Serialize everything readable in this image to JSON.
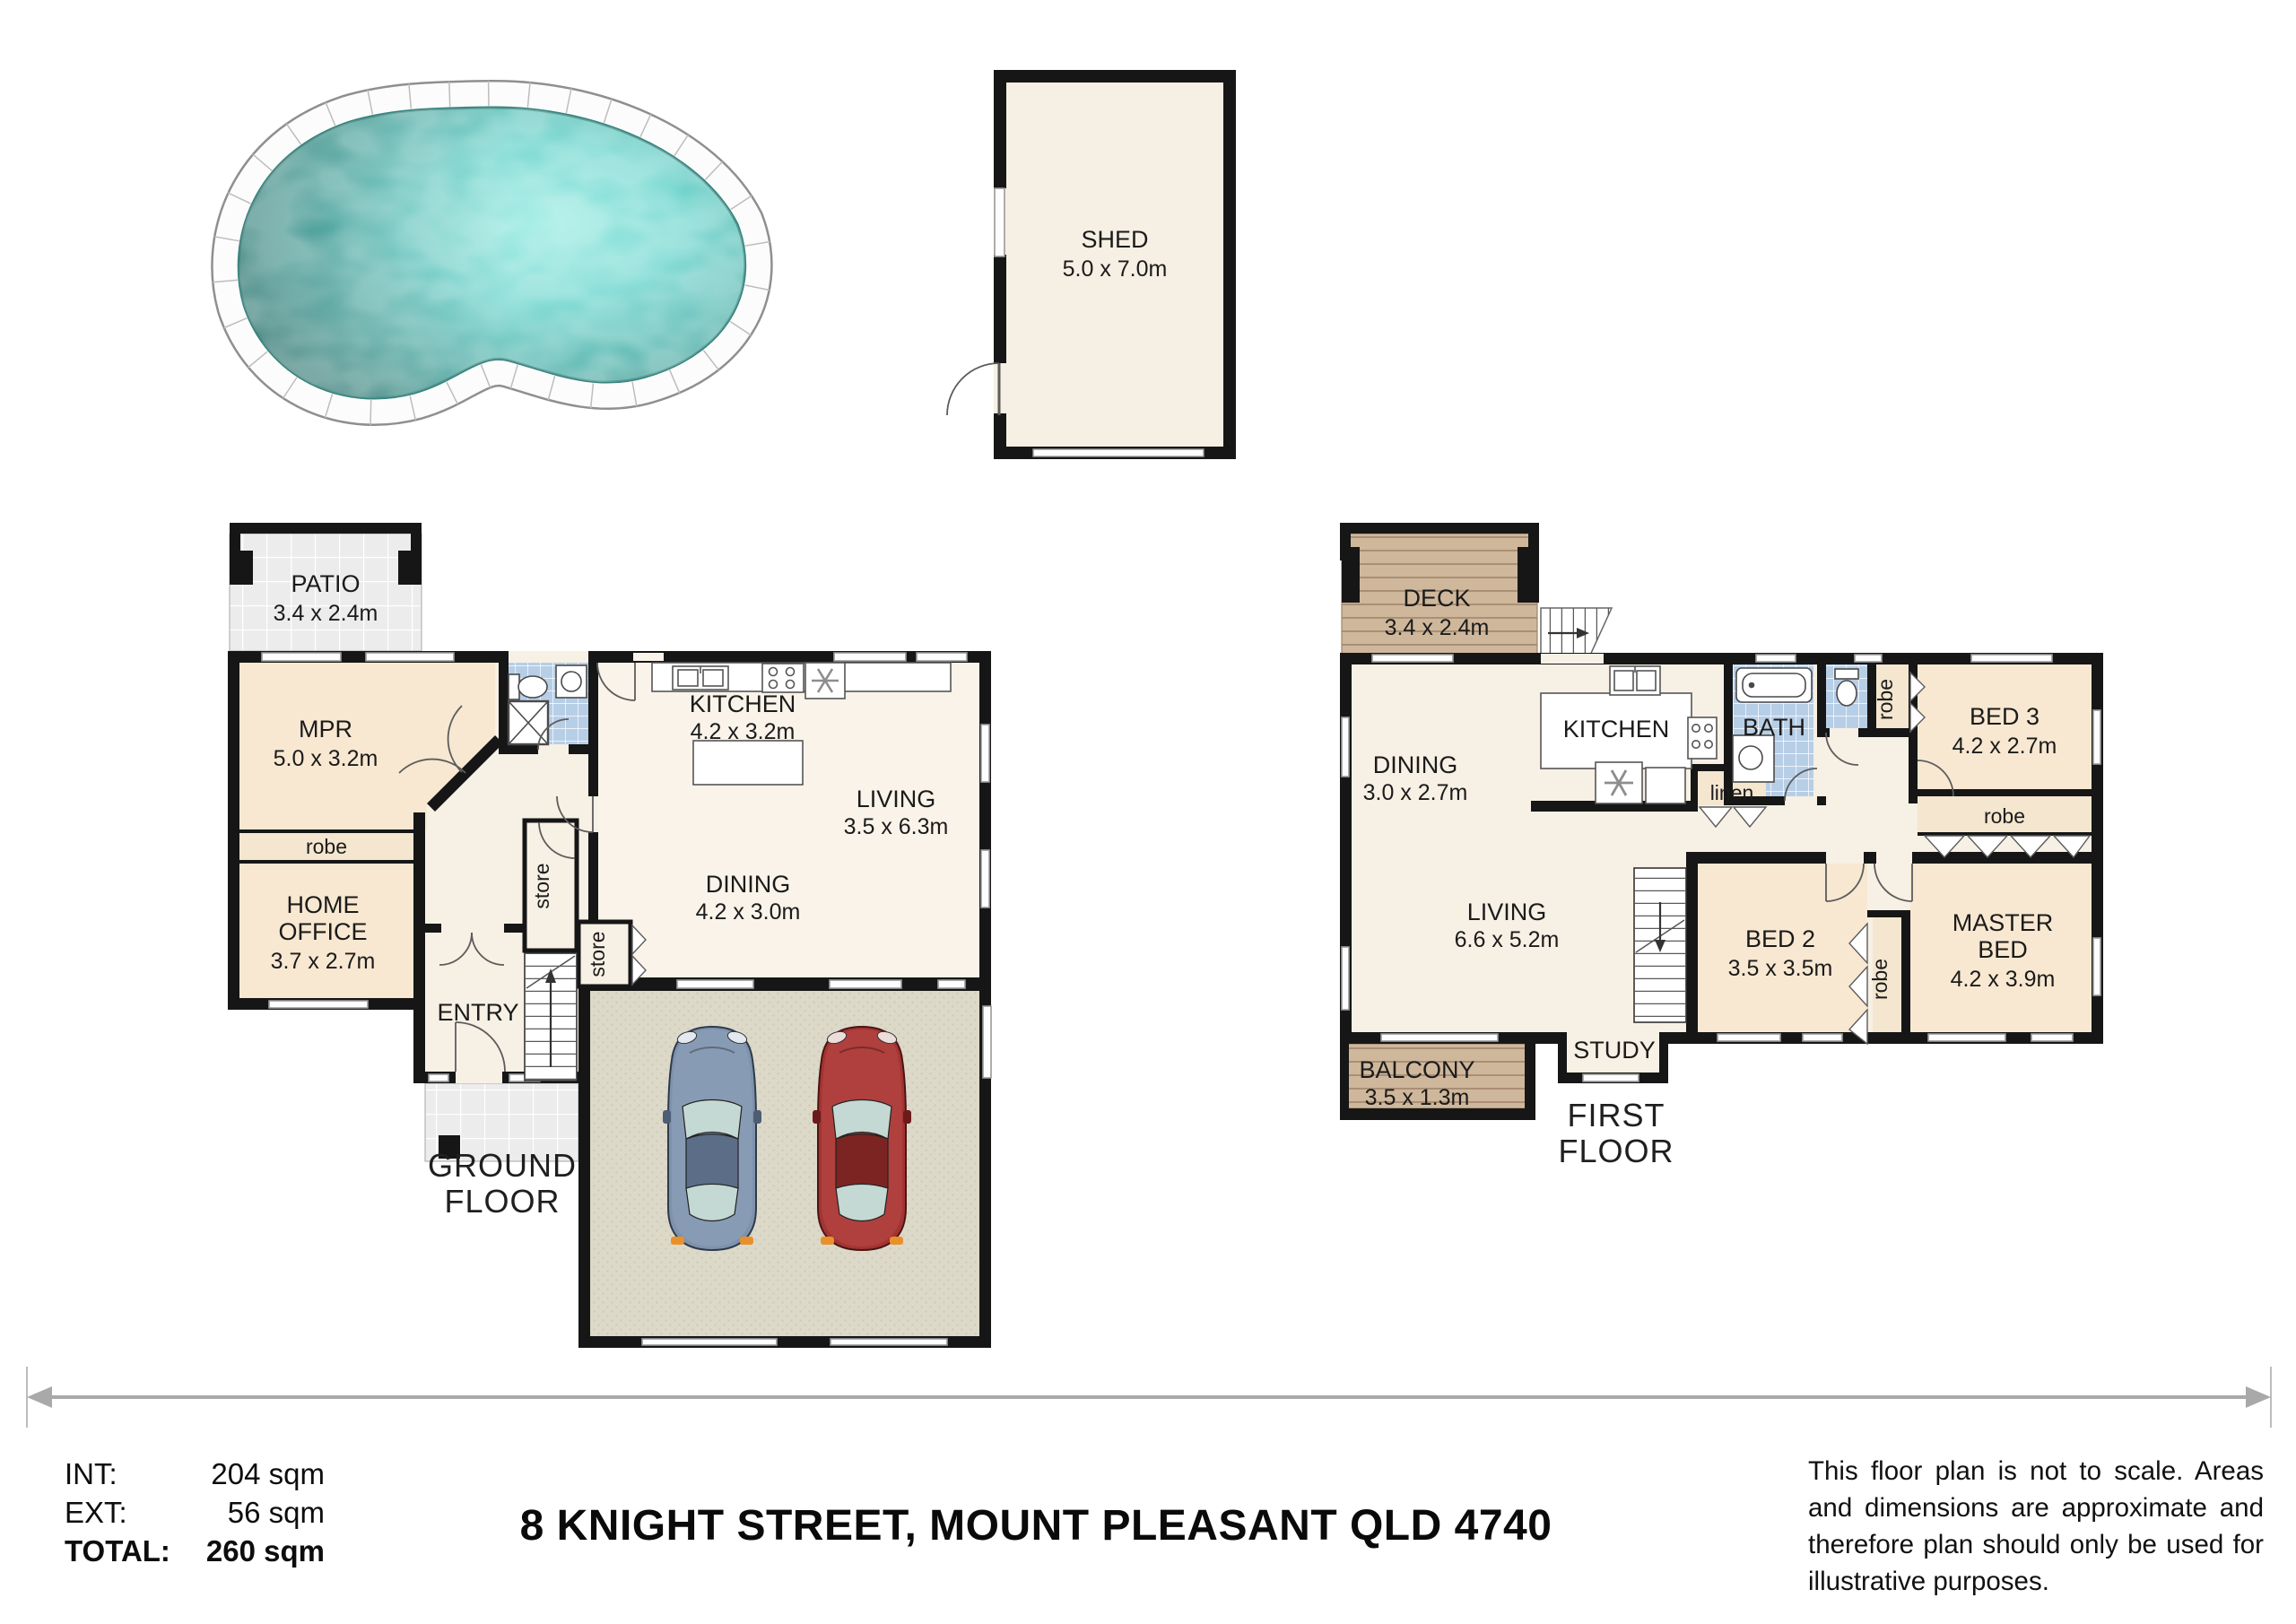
{
  "title": "8 KNIGHT STREET, MOUNT PLEASANT QLD 4740",
  "summary": {
    "int_label": "INT:",
    "int_value": "204 sqm",
    "ext_label": "EXT:",
    "ext_value": "56 sqm",
    "total_label": "TOTAL:",
    "total_value": "260 sqm"
  },
  "disclaimer": "This floor plan is not to scale. Areas and dimensions are approximate and therefore plan should only be used for illustrative purposes.",
  "shed": {
    "name": "SHED",
    "dims": "5.0 x 7.0m"
  },
  "ground_floor": {
    "floor_label": {
      "line1": "GROUND",
      "line2": "FLOOR"
    },
    "patio": {
      "name": "PATIO",
      "dims": "3.4 x 2.4m"
    },
    "mpr": {
      "name": "MPR",
      "dims": "5.0 x 3.2m"
    },
    "kitchen": {
      "name": "KITCHEN",
      "dims": "4.2 x 3.2m"
    },
    "living": {
      "name": "LIVING",
      "dims": "3.5 x 6.3m"
    },
    "dining": {
      "name": "DINING",
      "dims": "4.2 x 3.0m"
    },
    "home_office": {
      "line1": "HOME",
      "line2": "OFFICE",
      "dims": "3.7 x 2.7m"
    },
    "entry": {
      "name": "ENTRY"
    },
    "robe": {
      "name": "robe"
    },
    "store_hall": {
      "name": "store"
    },
    "store_dining": {
      "name": "store"
    }
  },
  "first_floor": {
    "floor_label": {
      "line1": "FIRST",
      "line2": "FLOOR"
    },
    "deck": {
      "name": "DECK",
      "dims": "3.4 x 2.4m"
    },
    "balcony": {
      "name": "BALCONY",
      "dims": "3.5 x 1.3m"
    },
    "dining": {
      "name": "DINING",
      "dims": "3.0 x 2.7m"
    },
    "kitchen": {
      "name": "KITCHEN"
    },
    "living": {
      "name": "LIVING",
      "dims": "6.6 x 5.2m"
    },
    "bath": {
      "name": "BATH"
    },
    "linen": {
      "name": "linen"
    },
    "study": {
      "name": "STUDY"
    },
    "bed2": {
      "name": "BED 2",
      "dims": "3.5 x 3.5m"
    },
    "bed3": {
      "name": "BED 3",
      "dims": "4.2 x 2.7m"
    },
    "master_bed": {
      "line1": "MASTER",
      "line2": "BED",
      "dims": "4.2 x 3.9m"
    },
    "robe_hall": {
      "name": "robe"
    },
    "robe_bed3": {
      "name": "robe"
    },
    "robe_master": {
      "name": "robe"
    }
  },
  "colors": {
    "wall": "#161616",
    "room_cream": "#f7f0e4",
    "room_light": "#f9f3e9",
    "room_peach": "#f8e8d1",
    "closet": "#f4e6cf",
    "bath_tile": "#b7cee7",
    "wood": "#cfb79c",
    "patio_tile": "#ececec",
    "garage_floor": "#dcd9c9",
    "pool_water": "#5cc6be",
    "scale_line": "#a9a9a9"
  }
}
